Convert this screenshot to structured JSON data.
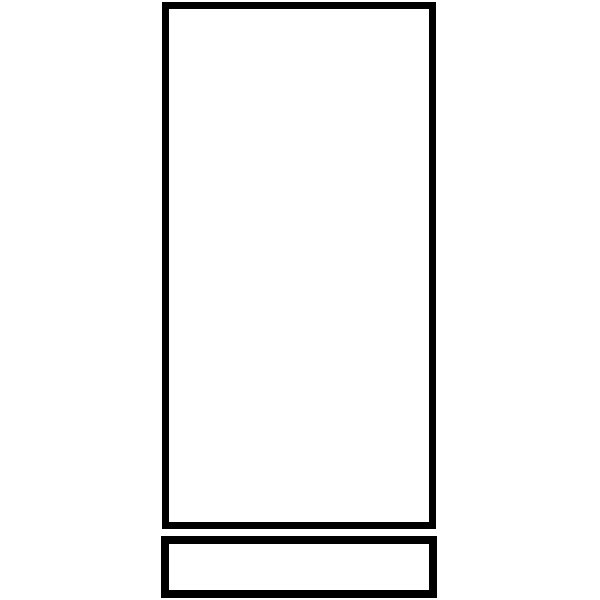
{
  "canvas": {
    "width": 600,
    "height": 600,
    "background_color": "#ffffff"
  },
  "drawing": {
    "description": "line-drawing-of-tall-rectangle-with-bottom-bar",
    "stroke_color": "#000000",
    "fill_color": "#ffffff",
    "shapes": [
      {
        "name": "tall-rectangle-outline",
        "type": "rect",
        "x": 165.5,
        "y": 5.5,
        "width": 267,
        "height": 520,
        "stroke_width": 7
      },
      {
        "name": "bottom-bar-outline",
        "type": "rect",
        "x": 165,
        "y": 540,
        "width": 268,
        "height": 54,
        "stroke_width": 8
      }
    ]
  }
}
